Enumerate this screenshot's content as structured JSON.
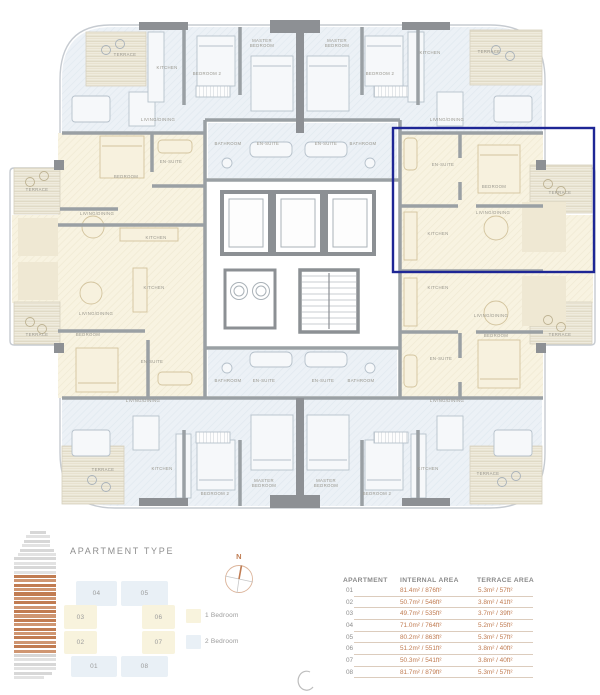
{
  "palette": {
    "accent": "#c07c52",
    "highlight": "#1e2695",
    "one_bed_fill": "#f8f3dd",
    "two_bed_fill": "#e9f0f6",
    "wall_gray": "#9aa0a4",
    "text_gray": "#8e8e8e"
  },
  "plan": {
    "highlight_color": "#1e2695",
    "labels": [
      {
        "t": "TERRACE",
        "x": 125,
        "y": 56
      },
      {
        "t": "KITCHEN",
        "x": 167,
        "y": 69
      },
      {
        "t": "BEDROOM 2",
        "x": 207,
        "y": 75
      },
      {
        "t": "MASTER\nBEDROOM",
        "x": 262,
        "y": 42
      },
      {
        "t": "MASTER\nBEDROOM",
        "x": 337,
        "y": 42
      },
      {
        "t": "BEDROOM 2",
        "x": 380,
        "y": 75
      },
      {
        "t": "KITCHEN",
        "x": 430,
        "y": 54
      },
      {
        "t": "TERRACE",
        "x": 489,
        "y": 53
      },
      {
        "t": "LIVING/DINING",
        "x": 158,
        "y": 121
      },
      {
        "t": "LIVING/DINING",
        "x": 447,
        "y": 121
      },
      {
        "t": "BATHROOM",
        "x": 228,
        "y": 145
      },
      {
        "t": "EN-SUITE",
        "x": 268,
        "y": 145
      },
      {
        "t": "EN-SUITE",
        "x": 326,
        "y": 145
      },
      {
        "t": "BATHROOM",
        "x": 363,
        "y": 145
      },
      {
        "t": "EN-SUITE",
        "x": 171,
        "y": 163
      },
      {
        "t": "BEDROOM",
        "x": 126,
        "y": 178
      },
      {
        "t": "TERRACE",
        "x": 37,
        "y": 191
      },
      {
        "t": "LIVING/DINING",
        "x": 97,
        "y": 215
      },
      {
        "t": "KITCHEN",
        "x": 156,
        "y": 239
      },
      {
        "t": "EN-SUITE",
        "x": 443,
        "y": 166
      },
      {
        "t": "BEDROOM",
        "x": 494,
        "y": 188
      },
      {
        "t": "TERRACE",
        "x": 560,
        "y": 194
      },
      {
        "t": "LIVING/DINING",
        "x": 493,
        "y": 214
      },
      {
        "t": "KITCHEN",
        "x": 438,
        "y": 235
      },
      {
        "t": "KITCHEN",
        "x": 154,
        "y": 289
      },
      {
        "t": "LIVING/DINING",
        "x": 96,
        "y": 315
      },
      {
        "t": "TERRACE",
        "x": 37,
        "y": 336
      },
      {
        "t": "BEDROOM",
        "x": 88,
        "y": 336
      },
      {
        "t": "EN-SUITE",
        "x": 152,
        "y": 363
      },
      {
        "t": "KITCHEN",
        "x": 438,
        "y": 289
      },
      {
        "t": "LIVING/DINING",
        "x": 491,
        "y": 317
      },
      {
        "t": "BEDROOM",
        "x": 496,
        "y": 337
      },
      {
        "t": "TERRACE",
        "x": 560,
        "y": 336
      },
      {
        "t": "EN-SUITE",
        "x": 441,
        "y": 360
      },
      {
        "t": "BATHROOM",
        "x": 228,
        "y": 382
      },
      {
        "t": "EN-SUITE",
        "x": 264,
        "y": 382
      },
      {
        "t": "EN-SUITE",
        "x": 323,
        "y": 382
      },
      {
        "t": "BATHROOM",
        "x": 361,
        "y": 382
      },
      {
        "t": "LIVING/DINING",
        "x": 143,
        "y": 402
      },
      {
        "t": "LIVING/DINING",
        "x": 447,
        "y": 402
      },
      {
        "t": "TERRACE",
        "x": 103,
        "y": 471
      },
      {
        "t": "KITCHEN",
        "x": 162,
        "y": 470
      },
      {
        "t": "BEDROOM 2",
        "x": 215,
        "y": 495
      },
      {
        "t": "MASTER\nBEDROOM",
        "x": 264,
        "y": 482
      },
      {
        "t": "MASTER\nBEDROOM",
        "x": 326,
        "y": 482
      },
      {
        "t": "BEDROOM 2",
        "x": 377,
        "y": 495
      },
      {
        "t": "KITCHEN",
        "x": 428,
        "y": 470
      },
      {
        "t": "TERRACE",
        "x": 488,
        "y": 475
      }
    ]
  },
  "legend": {
    "title": "APARTMENT TYPE",
    "compass_label": "N",
    "building_stack": {
      "total": 34,
      "highlight_start": 10,
      "highlight_end": 27
    },
    "types": [
      {
        "key": "b1",
        "label": "1 Bedroom",
        "color": "#f8f3dd"
      },
      {
        "key": "b2",
        "label": "2 Bedroom",
        "color": "#e9f0f6"
      }
    ],
    "key_units": [
      {
        "id": "04",
        "type": "b2",
        "x": 76,
        "y": 581,
        "w": 41,
        "h": 25
      },
      {
        "id": "05",
        "type": "b2",
        "x": 121,
        "y": 581,
        "w": 47,
        "h": 25
      },
      {
        "id": "03",
        "type": "b1",
        "x": 64,
        "y": 605,
        "w": 33,
        "h": 24
      },
      {
        "id": "06",
        "type": "b1",
        "x": 142,
        "y": 605,
        "w": 33,
        "h": 24
      },
      {
        "id": "02",
        "type": "b1",
        "x": 64,
        "y": 631,
        "w": 33,
        "h": 23
      },
      {
        "id": "07",
        "type": "b1",
        "x": 142,
        "y": 631,
        "w": 33,
        "h": 23
      },
      {
        "id": "01",
        "type": "b2",
        "x": 71,
        "y": 656,
        "w": 46,
        "h": 21
      },
      {
        "id": "08",
        "type": "b2",
        "x": 121,
        "y": 656,
        "w": 47,
        "h": 21
      }
    ]
  },
  "table": {
    "headers": [
      "APARTMENT",
      "INTERNAL AREA",
      "TERRACE AREA"
    ],
    "rows": [
      {
        "apartment": "01",
        "internal": "81.4m² / 876ft²",
        "terrace": "5.3m² / 57ft²"
      },
      {
        "apartment": "02",
        "internal": "50.7m² / 546ft²",
        "terrace": "3.8m² / 41ft²"
      },
      {
        "apartment": "03",
        "internal": "49.7m² / 535ft²",
        "terrace": "3.7m² / 39ft²"
      },
      {
        "apartment": "04",
        "internal": "71.0m² / 764ft²",
        "terrace": "5.2m² / 55ft²"
      },
      {
        "apartment": "05",
        "internal": "80.2m² / 863ft²",
        "terrace": "5.3m² / 57ft²"
      },
      {
        "apartment": "06",
        "internal": "51.2m² / 551ft²",
        "terrace": "3.8m² / 40ft²"
      },
      {
        "apartment": "07",
        "internal": "50.3m² / 541ft²",
        "terrace": "3.8m² / 40ft²"
      },
      {
        "apartment": "08",
        "internal": "81.7m² / 879ft²",
        "terrace": "5.3m² / 57ft²"
      }
    ]
  }
}
